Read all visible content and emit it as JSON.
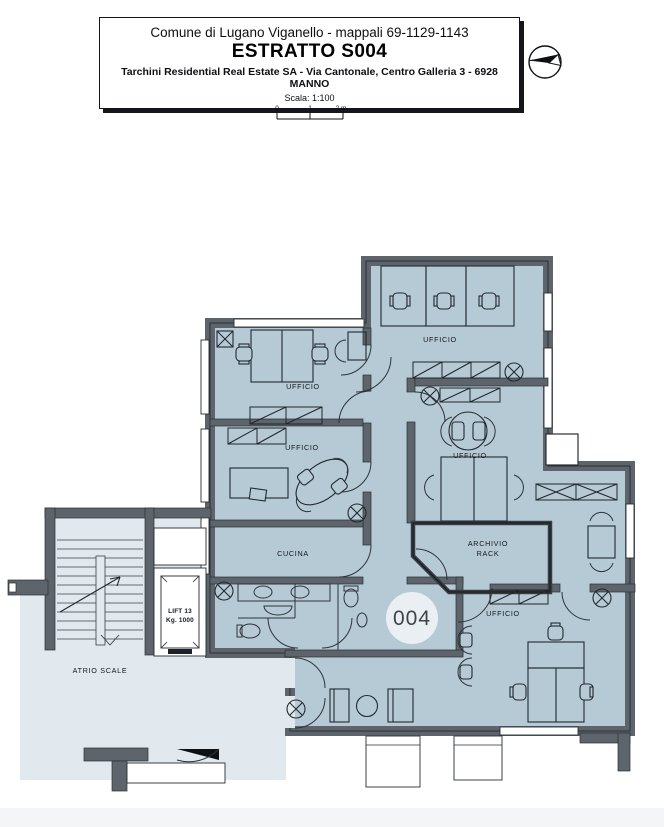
{
  "title_block": {
    "line1": "Comune di Lugano Viganello - mappali 69-1129-1143",
    "title": "ESTRATTO S004",
    "line2": "Tarchini Residential Real Estate SA  - Via Cantonale, Centro Galleria 3 - 6928 MANNO",
    "scale_label": "Scala: 1:100",
    "scale_tick_0": "0",
    "scale_tick_1": "1",
    "scale_tick_2": "2 m"
  },
  "plan": {
    "unit_number": "004",
    "labels": {
      "ufficio_top_left": "UFFICIO",
      "ufficio_mid_left": "UFFICIO",
      "ufficio_top_right": "UFFICIO",
      "ufficio_center": "UFFICIO",
      "ufficio_bottom_right": "UFFICIO",
      "cucina": "CUCINA",
      "archivio_line1": "ARCHIVIO",
      "archivio_line2": "RACK",
      "lift_line1": "LIFT 13",
      "lift_line2": "Kg. 1000",
      "atrio": "ATRIO SCALE"
    }
  },
  "colors": {
    "floor": "#b6cad6",
    "atrio": "#e1e9ee",
    "wall": "#5d646b",
    "line": "#23282f",
    "badge": "#e9eff3"
  }
}
